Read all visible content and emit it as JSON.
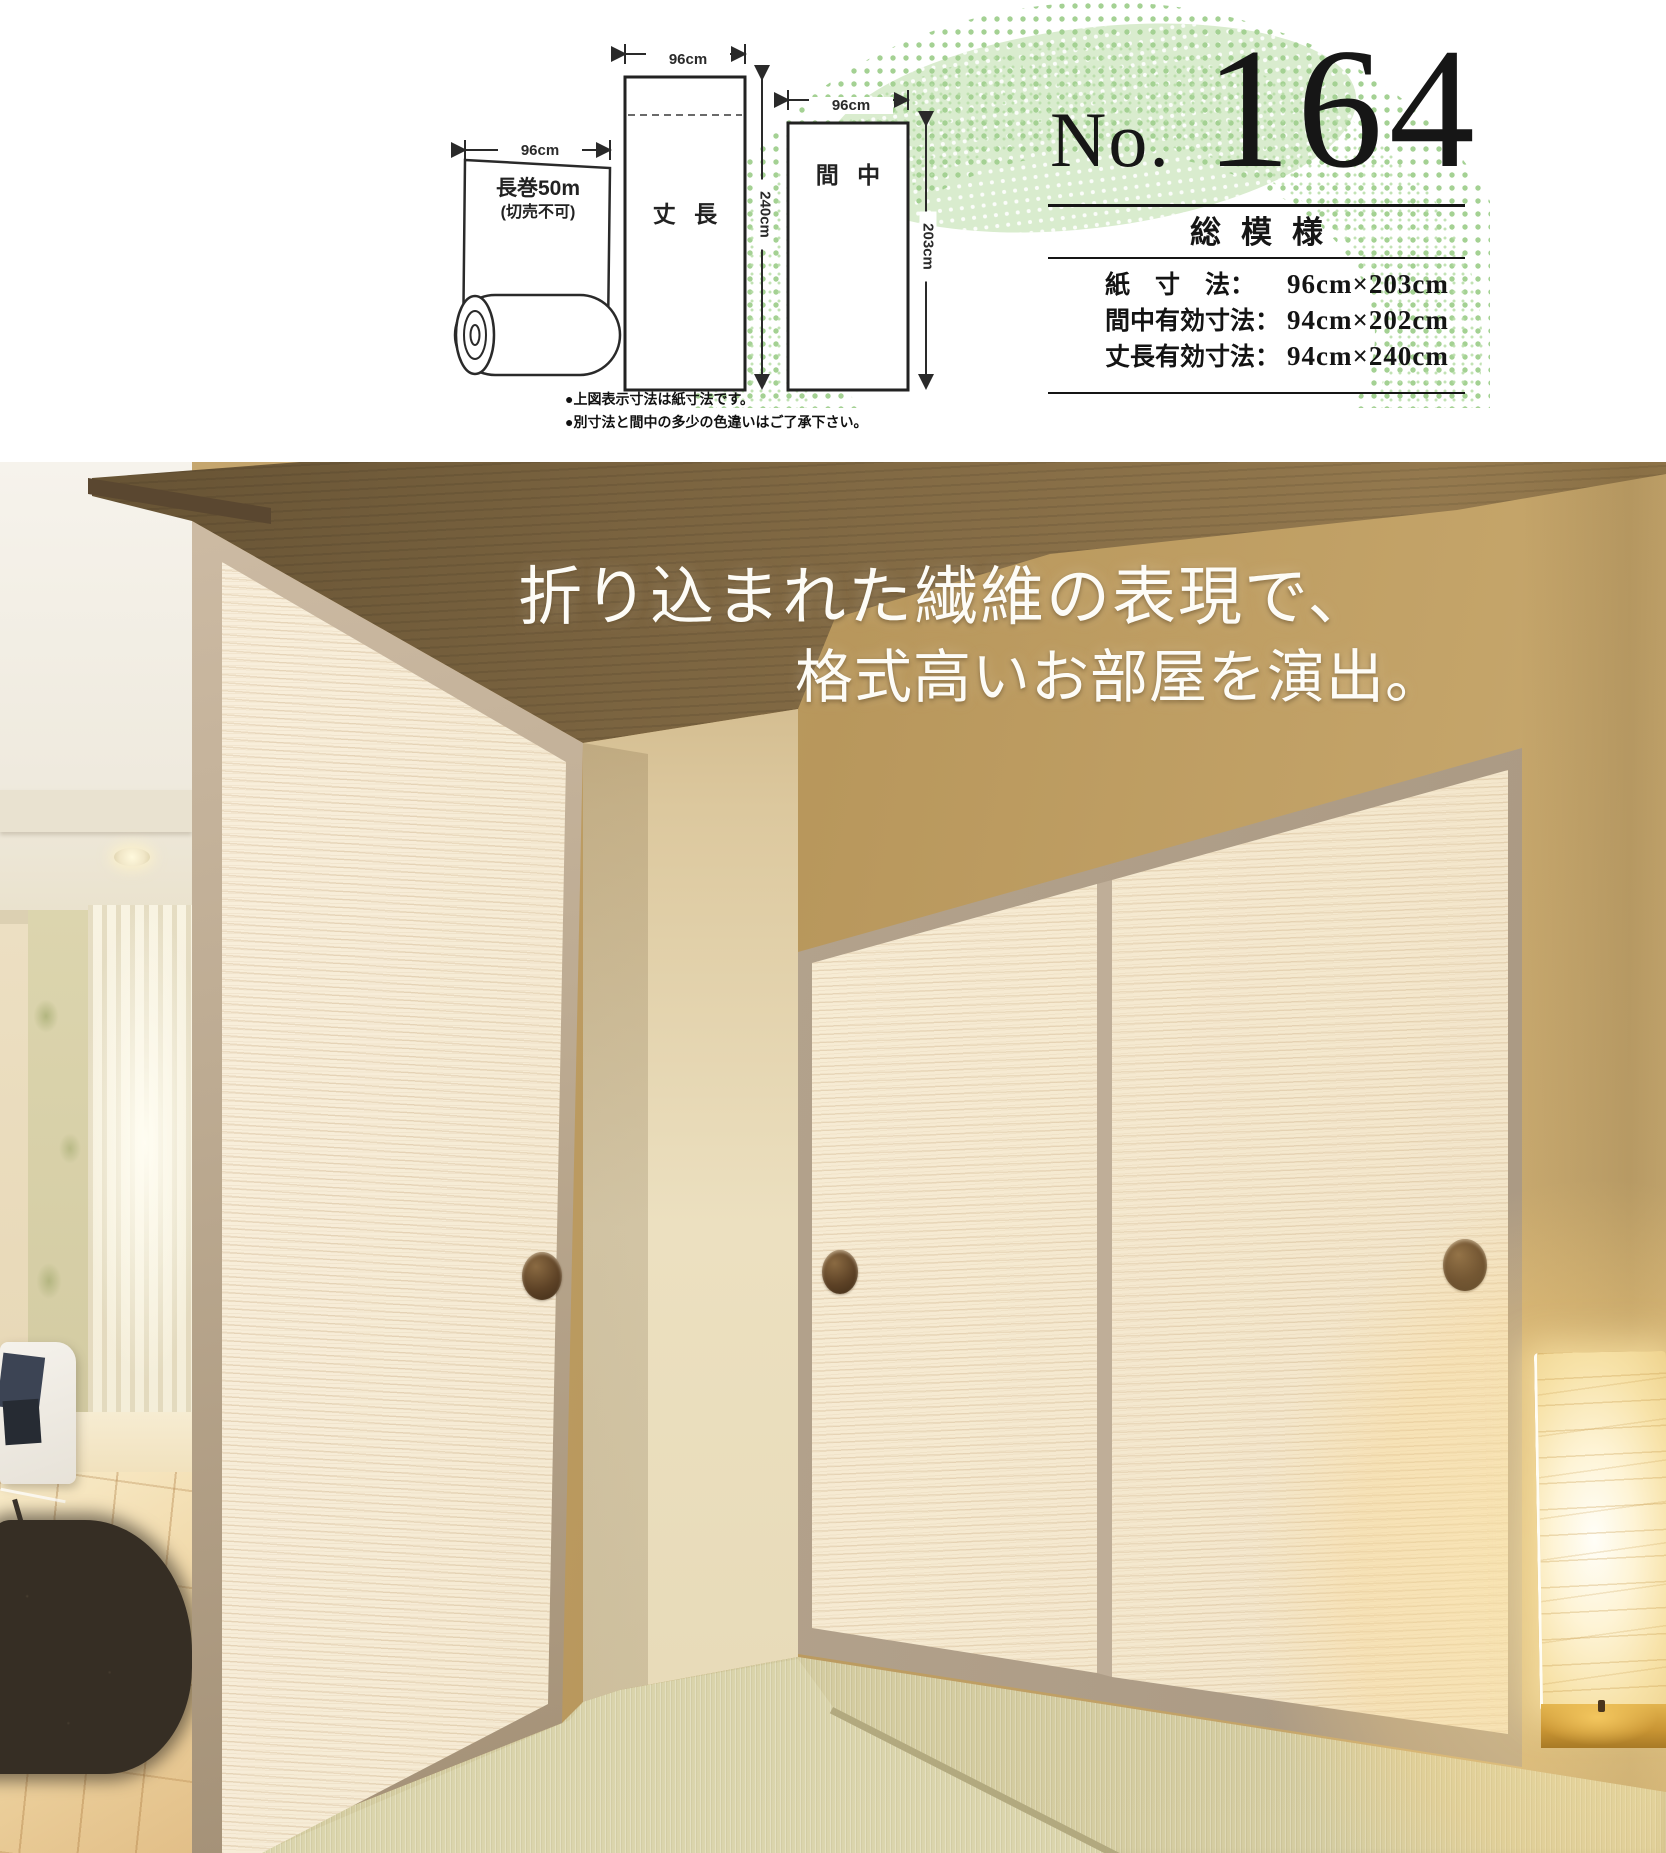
{
  "header": {
    "diagram": {
      "roll_width": "96cm",
      "roll_line1": "長巻50m",
      "roll_line2": "(切売不可)",
      "takecho_width": "96cm",
      "takecho_name": "丈 長",
      "takecho_height": "240cm",
      "manaka_width": "96cm",
      "manaka_name": "間 中",
      "manaka_height": "203cm",
      "note1": "●上図表示寸法は紙寸法です。",
      "note2": "●別寸法と間中の多少の色違いはご了承下さい。"
    },
    "product": {
      "no_prefix": "No.",
      "number": "164",
      "series": "総模様",
      "specs": [
        {
          "label": "紙　寸　法：",
          "value": "96cm×203cm"
        },
        {
          "label": "間中有効寸法：",
          "value": "94cm×202cm"
        },
        {
          "label": "丈長有効寸法：",
          "value": "94cm×240cm"
        }
      ]
    },
    "accent_green": "#a6d095"
  },
  "photo": {
    "caption_line1": "折り込まれた繊維の表現で、",
    "caption_line2": "格式高いお部屋を演出。",
    "colors": {
      "wall": "#c0a167",
      "ceiling": "#6f5837",
      "fusuma_paper": "#f6ecd8",
      "frame": "#b7a791",
      "tatami": "#cfc79d"
    }
  }
}
